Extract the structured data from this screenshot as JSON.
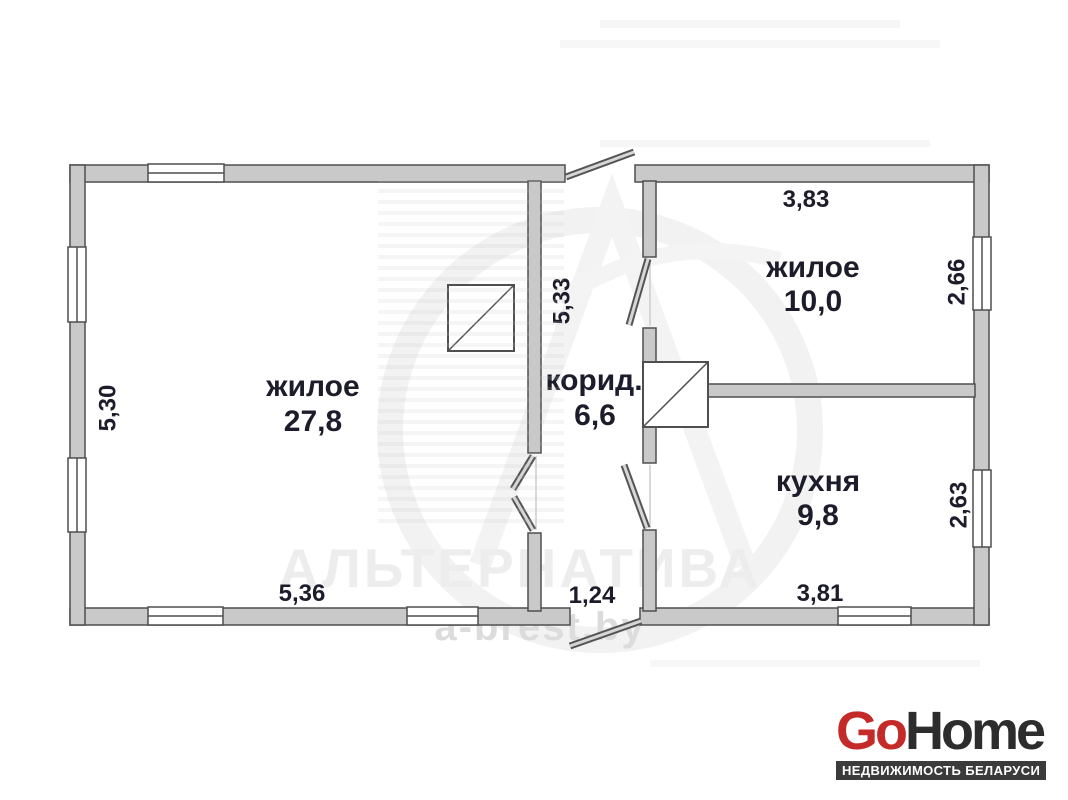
{
  "plan": {
    "rooms": [
      {
        "name": "жилое",
        "area": "27,8"
      },
      {
        "name": "корид.",
        "area": "6,6"
      },
      {
        "name": "жилое",
        "area": "10,0"
      },
      {
        "name": "кухня",
        "area": "9,8"
      }
    ],
    "dims": {
      "living_height": "5,30",
      "living_width": "5,36",
      "corridor_height": "5,33",
      "corridor_width": "1,24",
      "room2_width": "3,83",
      "room2_height": "2,66",
      "kitchen_height": "2,63",
      "kitchen_width": "3,81"
    }
  },
  "watermark": {
    "name": "АЛЬТЕРНАТИВА",
    "site": "a-brest.by"
  },
  "logo": {
    "go": "Go",
    "home": "Home",
    "tagline": "НЕДВИЖИМОСТЬ БЕЛАРУСИ"
  },
  "colors": {
    "wall_fill": "#c9c9c9",
    "wall_stroke": "#4f4f4f",
    "label_text": "#1c1c2b",
    "logo_red": "#c42a28",
    "logo_dark": "#2d2d2d",
    "tagline_bg": "#3b3b3b",
    "watermark_grey": "#ededed"
  }
}
